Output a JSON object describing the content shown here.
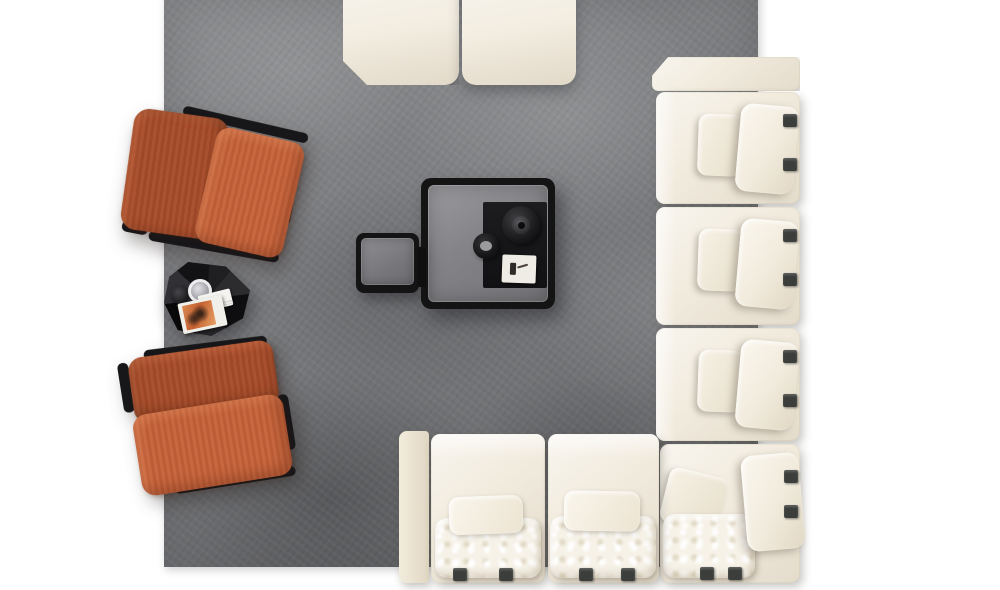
{
  "meta": {
    "type": "furniture-lifestyle-photo",
    "view": "top-down",
    "description": "Top view of a living room arrangement on a gray rug"
  },
  "palette": {
    "background": "#ffffff",
    "carpet": "#797a7d",
    "sofa": "#f0e9da",
    "cushion": "#f6f2e8",
    "strap": "#3b3e3b",
    "table-black": "#141415",
    "frame-black": "#17171a",
    "chair-back": "#a84c2a",
    "chair-seat": "#c6633a",
    "card": "#efece6",
    "magazine-orange": "#c4602f",
    "glass-gray": "#848488"
  },
  "scene": {
    "rug": {
      "name": "gray suede area rug"
    },
    "sectional_sofa": {
      "name": "cream modular sectional sofa",
      "right_modules": 3,
      "bottom_modules": 2,
      "corner_modules": 1,
      "ottoman_modules": 2,
      "back_pillows": 4,
      "seat_cushions": 3
    },
    "armchairs": [
      {
        "name": "rust velvet lounge chair (upper)"
      },
      {
        "name": "rust velvet lounge chair (lower)"
      }
    ],
    "tables": [
      {
        "name": "black square coffee table with smoked glass top"
      },
      {
        "name": "black square side table"
      },
      {
        "name": "black faceted accent table"
      }
    ],
    "decor": [
      {
        "name": "black pedestal bowl"
      },
      {
        "name": "small black ashtray bowl"
      },
      {
        "name": "white art card"
      },
      {
        "name": "black tray runner"
      },
      {
        "name": "magazine with orange cover"
      },
      {
        "name": "book page stack"
      },
      {
        "name": "drinking glass"
      },
      {
        "name": "small dark bowl"
      }
    ]
  }
}
